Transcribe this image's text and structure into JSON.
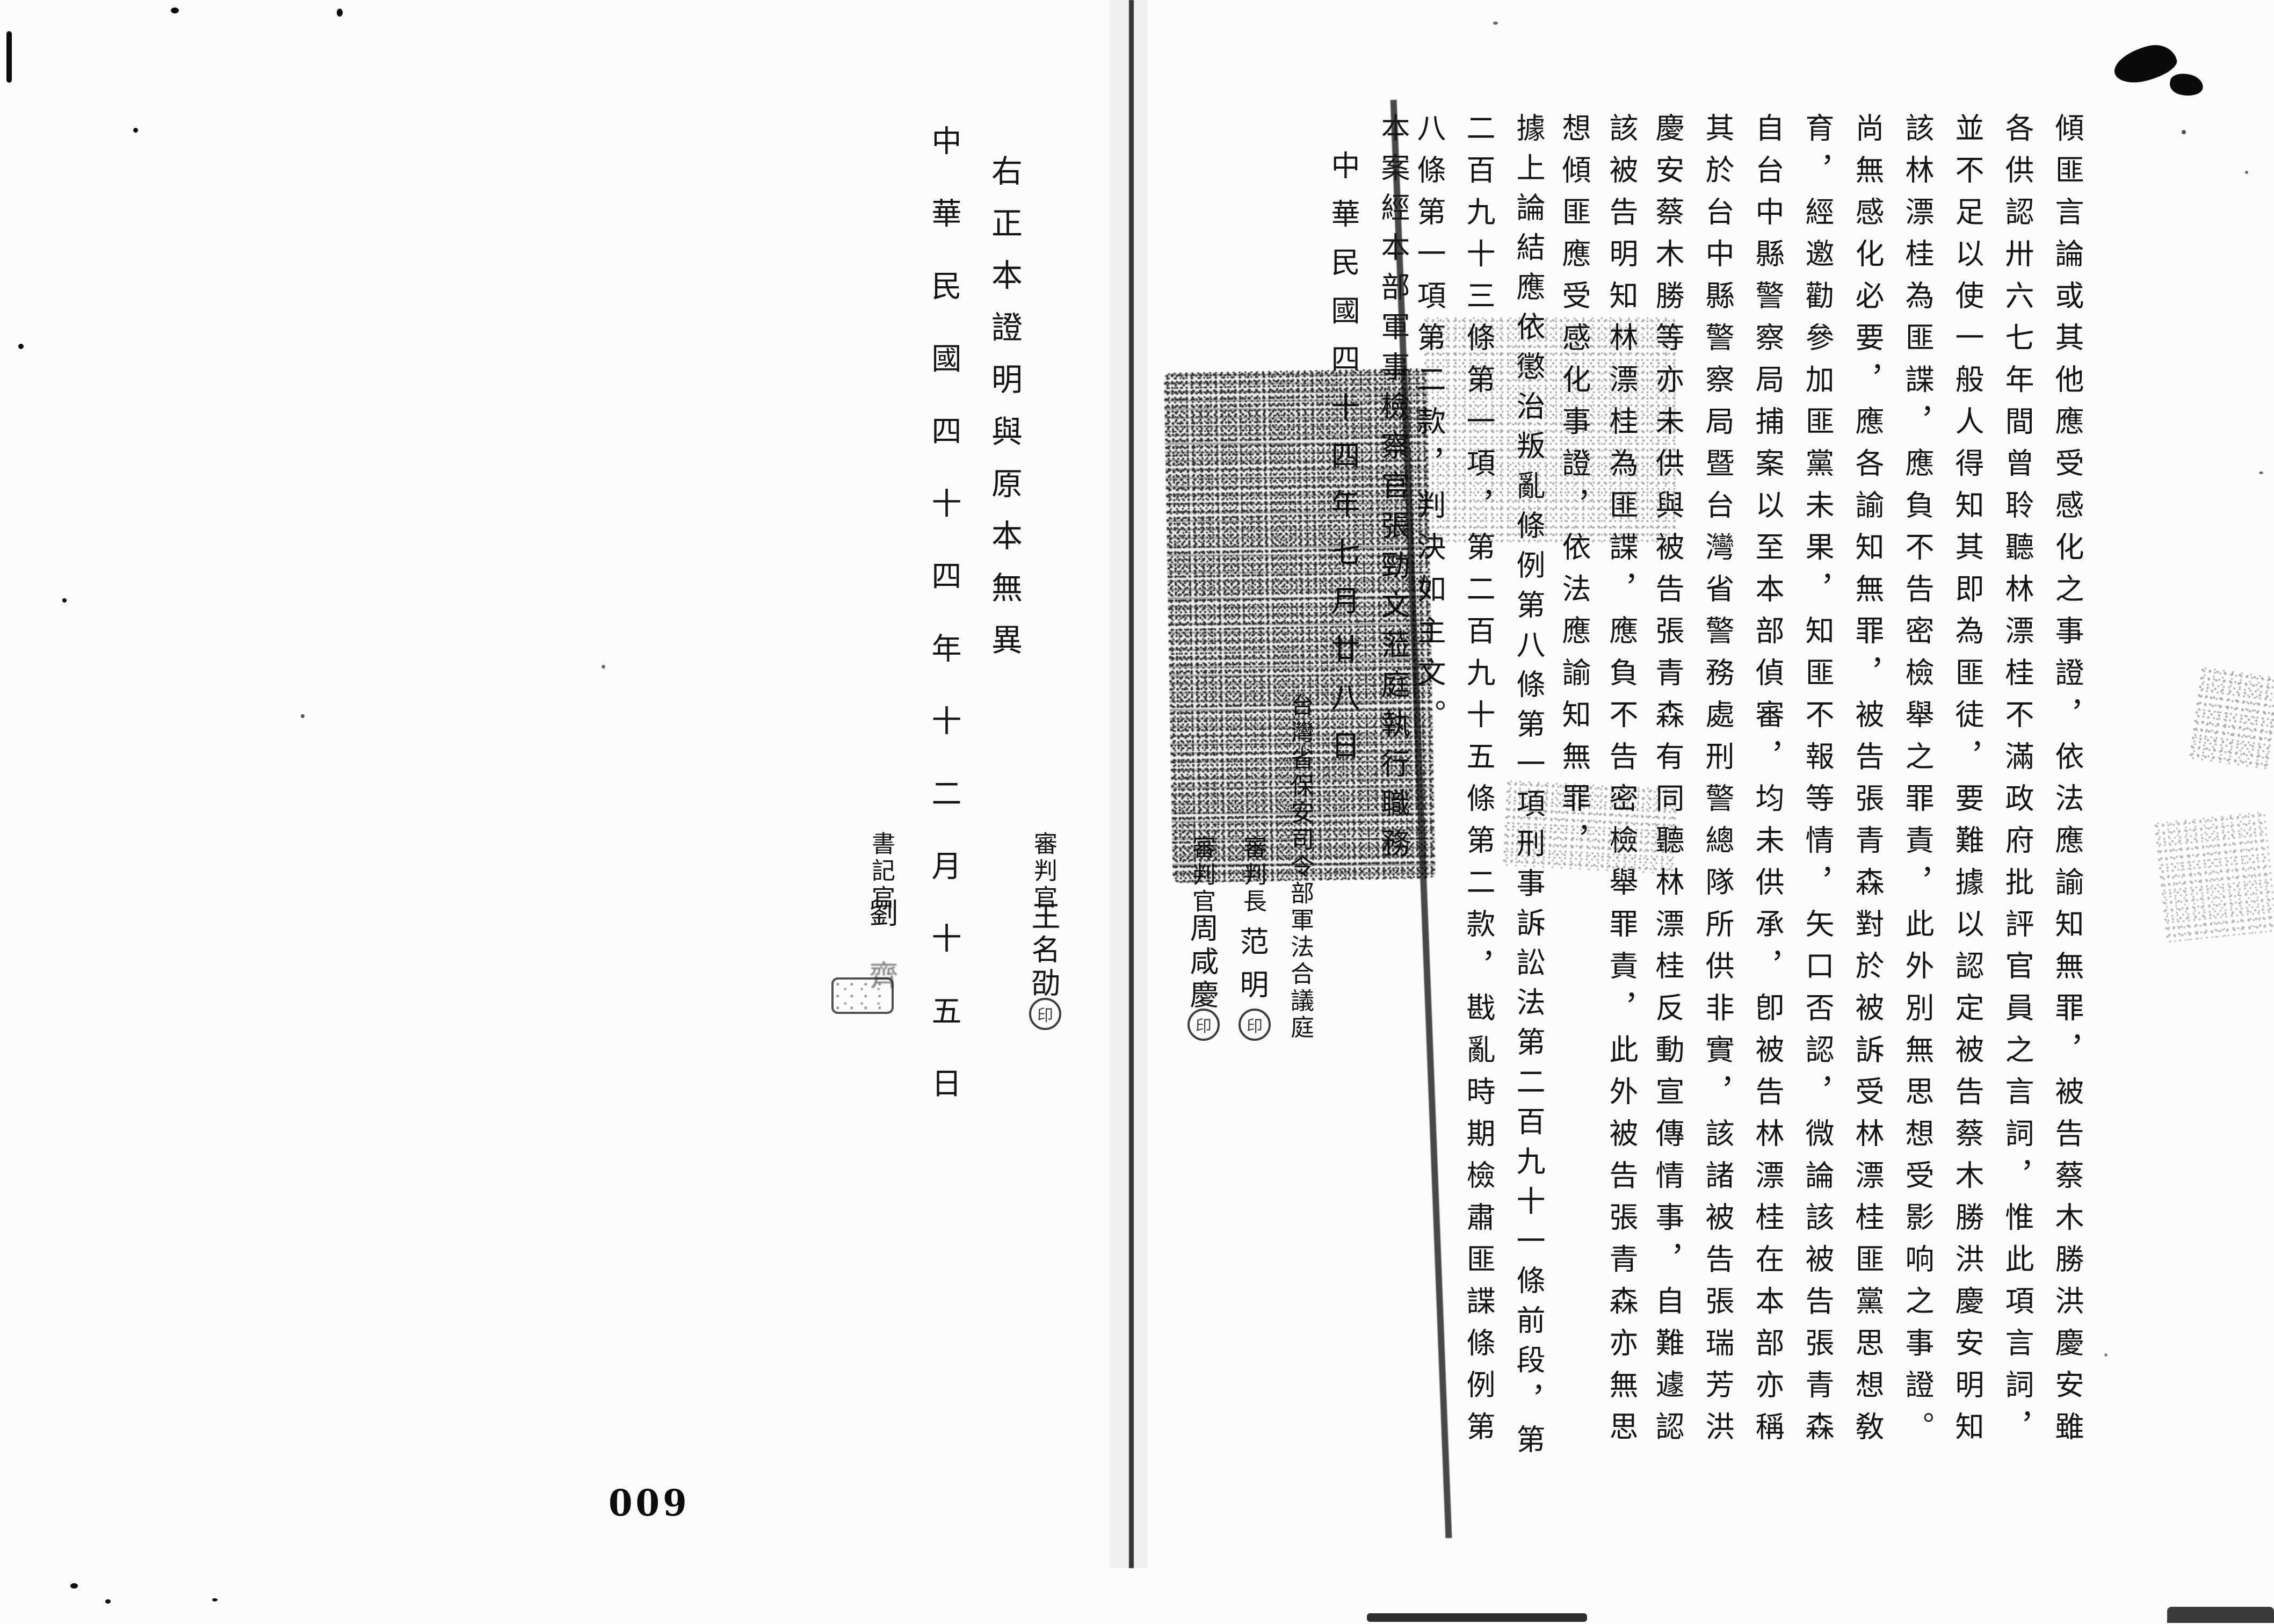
{
  "document_type": "scanned military court judgment copy (Republic of China, 1955)",
  "colors": {
    "paper": "#fcfcfb",
    "ink": "#141414"
  },
  "page_number": "009",
  "right_page": {
    "columns": [
      "傾匪言論或其他應受感化之事證，依法應諭知無罪，被告蔡木勝洪慶安雖",
      "各供認卅六七年間曾聆聽林漂桂不滿政府批評官員之言詞，惟此項言詞，",
      "並不足以使一般人得知其即為匪徒，要難據以認定被告蔡木勝洪慶安明知",
      "該林漂桂為匪諜，應負不告密檢舉之罪責，此外別無思想受影响之事證。",
      "尚無感化必要，應各諭知無罪，被告張青森對於被訴受林漂桂匪黨思想敎",
      "育，經邀勸參加匪黨未果，知匪不報等情，矢口否認，微論該被告張青森",
      "自台中縣警察局捕案以至本部偵審，均未供承，卽被告林漂桂在本部亦稱",
      "其於台中縣警察局暨台灣省警務處刑警總隊所供非實，該諸被告張瑞芳洪",
      "慶安蔡木勝等亦未供與被告張青森有同聽林漂桂反動宣傳情事，自難遽認",
      "該被告明知林漂桂為匪諜，應負不告密檢舉罪責，此外被告張青森亦無思",
      "想傾匪應受感化事證，依法應諭知無罪，",
      "據上論結應依懲治叛亂條例第八條第一項刑事訴訟法第二百九十一條前段，第",
      "二百九十三條第一項，第二百九十五條第二款，戡亂時期檢肅匪諜條例第",
      "八條第一項第二款，判決如主文。",
      "本案經本部軍事檢察官張勁文蒞庭執行職務"
    ],
    "judgment_date": "中華民國四十四年七月廿八日",
    "court_name": "台灣省保安司令部軍法合議庭",
    "signatures": [
      {
        "title": "審判長",
        "name": "范明",
        "seal": "印"
      },
      {
        "title": "審判官",
        "name": "周咸慶",
        "seal": "印"
      }
    ]
  },
  "left_page": {
    "third_judge": {
      "title": "審判官",
      "name": "王名劭",
      "seal": "印"
    },
    "certification": "右正本證明與原本無異",
    "certification_date": "中華民國四十四年十二月十五日",
    "clerk": {
      "title": "書記官",
      "name_1": "劉",
      "name_2": "齊"
    }
  }
}
